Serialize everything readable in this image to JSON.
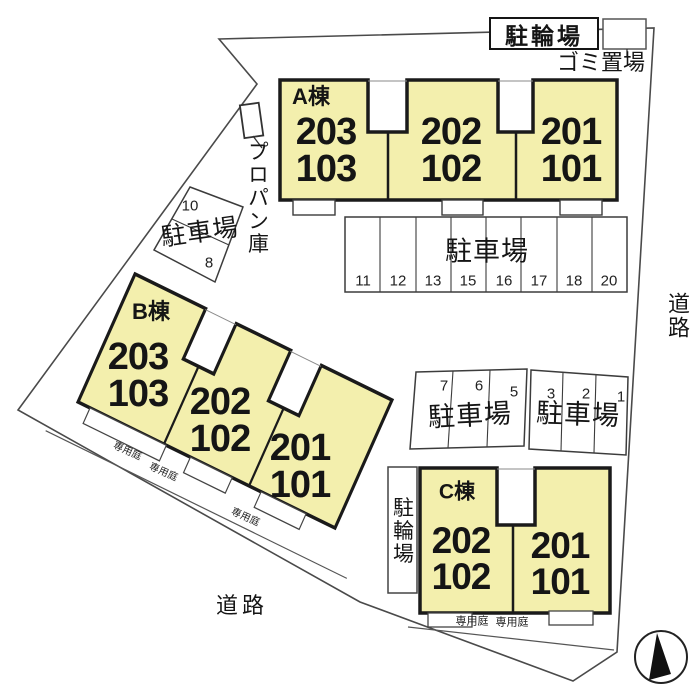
{
  "legend": {
    "bicycle": "駐輪場",
    "garbage": "ゴミ置場",
    "propane": "プロパン庫",
    "parking": "駐車場",
    "road": "道路",
    "garden": "専用庭"
  },
  "buildings": [
    {
      "label": "A棟",
      "units": [
        [
          "203",
          "103"
        ],
        [
          "202",
          "102"
        ],
        [
          "201",
          "101"
        ]
      ]
    },
    {
      "label": "B棟",
      "units": [
        [
          "203",
          "103"
        ],
        [
          "202",
          "102"
        ],
        [
          "201",
          "101"
        ]
      ]
    },
    {
      "label": "C棟",
      "units": [
        [
          "202",
          "102"
        ],
        [
          "201",
          "101"
        ]
      ]
    }
  ],
  "parking_numbers": {
    "west": [
      "10",
      "8"
    ],
    "row": [
      "11",
      "12",
      "13",
      "15",
      "16",
      "17",
      "18",
      "20"
    ],
    "mid_left": [
      "7",
      "6",
      "5"
    ],
    "mid_right": [
      "3",
      "2",
      "1"
    ]
  },
  "colors": {
    "unit_fill": "#f3efad",
    "outline": "#1a1a1a",
    "thin_line": "#4a4a4a"
  }
}
